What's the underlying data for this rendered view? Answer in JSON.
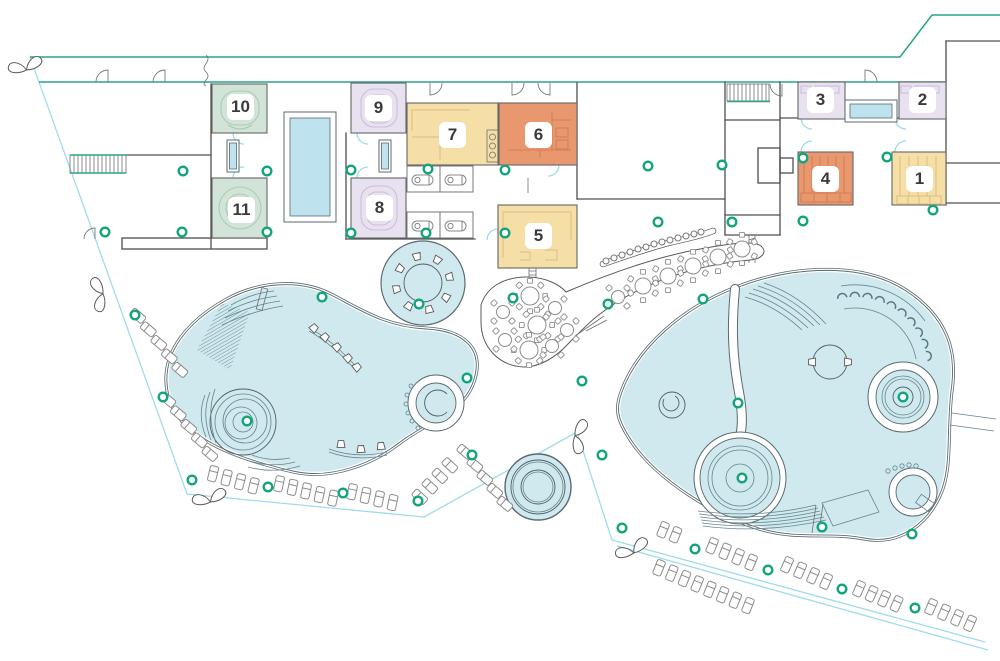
{
  "rooms": [
    {
      "number": "1",
      "zone": "yellow"
    },
    {
      "number": "2",
      "zone": "lavender"
    },
    {
      "number": "3",
      "zone": "lavender"
    },
    {
      "number": "4",
      "zone": "coral"
    },
    {
      "number": "5",
      "zone": "yellow"
    },
    {
      "number": "6",
      "zone": "coral"
    },
    {
      "number": "7",
      "zone": "yellow"
    },
    {
      "number": "8",
      "zone": "lavender"
    },
    {
      "number": "9",
      "zone": "lavender"
    },
    {
      "number": "10",
      "zone": "green"
    },
    {
      "number": "11",
      "zone": "green"
    }
  ],
  "colors": {
    "yellow_room": "#f5dfa6",
    "coral_room": "#e9976f",
    "lavender_room": "#e8e1ef",
    "green_room": "#d2e4d8",
    "pool_water": "#cfe9ef",
    "window_water": "#bfe3ee",
    "site_boundary_teal": "#2aa489",
    "site_boundary_cyan": "#9edcec",
    "column_marker": "#12a57c",
    "wall": "#4f4f4f"
  },
  "markers": {
    "columns": [
      [
        183,
        171
      ],
      [
        267,
        171
      ],
      [
        105,
        232
      ],
      [
        182,
        232
      ],
      [
        267,
        232
      ],
      [
        351,
        170
      ],
      [
        428,
        169
      ],
      [
        505,
        170
      ],
      [
        351,
        233
      ],
      [
        426,
        233
      ],
      [
        505,
        233
      ],
      [
        648,
        166
      ],
      [
        722,
        165
      ],
      [
        658,
        222
      ],
      [
        732,
        222
      ],
      [
        803,
        158
      ],
      [
        887,
        157
      ],
      [
        803,
        221
      ],
      [
        933,
        210
      ],
      [
        513,
        298
      ],
      [
        608,
        304
      ],
      [
        703,
        299
      ],
      [
        322,
        297
      ],
      [
        247,
        421
      ],
      [
        419,
        304
      ],
      [
        467,
        378
      ],
      [
        582,
        381
      ],
      [
        602,
        455
      ],
      [
        738,
        403
      ],
      [
        742,
        478
      ],
      [
        903,
        397
      ],
      [
        822,
        527
      ],
      [
        912,
        534
      ],
      [
        135,
        315
      ],
      [
        163,
        397
      ],
      [
        192,
        480
      ],
      [
        268,
        487
      ],
      [
        343,
        493
      ],
      [
        418,
        501
      ],
      [
        472,
        455
      ],
      [
        622,
        528
      ],
      [
        695,
        549
      ],
      [
        768,
        570
      ],
      [
        842,
        589
      ],
      [
        915,
        608
      ]
    ]
  },
  "furniture": {
    "lounger_rows": [
      {
        "x": 138,
        "y": 316,
        "dx": 10.5,
        "dy": 13.5,
        "n": 5,
        "rot": -50
      },
      {
        "x": 168,
        "y": 400,
        "dx": 10.5,
        "dy": 13.5,
        "n": 5,
        "rot": -50
      },
      {
        "x": 213,
        "y": 474,
        "dx": 13.5,
        "dy": 4.0,
        "n": 4,
        "rot": 14
      },
      {
        "x": 279,
        "y": 484,
        "dx": 13.5,
        "dy": 3.6,
        "n": 5,
        "rot": 12
      },
      {
        "x": 352,
        "y": 492,
        "dx": 13.5,
        "dy": 3.6,
        "n": 4,
        "rot": 12
      },
      {
        "x": 420,
        "y": 497,
        "dx": 10.0,
        "dy": -10.5,
        "n": 4,
        "rot": -47
      },
      {
        "x": 465,
        "y": 452,
        "dx": 10.0,
        "dy": 13.0,
        "n": 5,
        "rot": -50
      },
      {
        "x": 663,
        "y": 530,
        "dx": 12.5,
        "dy": 5.0,
        "n": 2,
        "rot": 22
      },
      {
        "x": 659,
        "y": 568,
        "dx": 12.7,
        "dy": 5.4,
        "n": 8,
        "rot": 22
      },
      {
        "x": 712,
        "y": 546,
        "dx": 13.0,
        "dy": 5.5,
        "n": 4,
        "rot": 22
      },
      {
        "x": 787,
        "y": 565,
        "dx": 13.0,
        "dy": 5.5,
        "n": 4,
        "rot": 24
      },
      {
        "x": 859,
        "y": 589,
        "dx": 12.5,
        "dy": 5.0,
        "n": 4,
        "rot": 24
      },
      {
        "x": 931,
        "y": 607,
        "dx": 13.0,
        "dy": 5.5,
        "n": 4,
        "rot": 24
      }
    ],
    "tables": [
      {
        "x": 530,
        "y": 296,
        "r": 9,
        "chairs": 8
      },
      {
        "x": 537,
        "y": 325,
        "r": 9,
        "chairs": 8
      },
      {
        "x": 529,
        "y": 350,
        "r": 9,
        "chairs": 8
      },
      {
        "x": 503,
        "y": 312,
        "r": 6.5,
        "chairs": 4
      },
      {
        "x": 555,
        "y": 308,
        "r": 6.5,
        "chairs": 4
      },
      {
        "x": 567,
        "y": 330,
        "r": 6.5,
        "chairs": 4
      },
      {
        "x": 505,
        "y": 340,
        "r": 6.5,
        "chairs": 4
      },
      {
        "x": 552,
        "y": 346,
        "r": 6.5,
        "chairs": 4
      },
      {
        "x": 618,
        "y": 297,
        "r": 6.5,
        "chairs": 4
      },
      {
        "x": 643,
        "y": 286,
        "r": 8,
        "chairs": 6
      },
      {
        "x": 668,
        "y": 276,
        "r": 8,
        "chairs": 6
      },
      {
        "x": 693,
        "y": 266,
        "r": 8,
        "chairs": 6
      },
      {
        "x": 718,
        "y": 257,
        "r": 8,
        "chairs": 6
      },
      {
        "x": 742,
        "y": 249,
        "r": 8,
        "chairs": 6
      }
    ],
    "bar_stools": [
      [
        606,
        261
      ],
      [
        614,
        258
      ],
      [
        622,
        255
      ],
      [
        630,
        252
      ],
      [
        638,
        249
      ],
      [
        646,
        247
      ],
      [
        654,
        244
      ],
      [
        662,
        242
      ],
      [
        670,
        240
      ],
      [
        678,
        238
      ],
      [
        686,
        236
      ],
      [
        694,
        234
      ],
      [
        701,
        232
      ]
    ],
    "water_loungers": {
      "cx": 855,
      "cy": 370,
      "r": 76,
      "a_start": 100,
      "a_end": 11,
      "count": 10
    },
    "jacuzzi_seats": {
      "cx": 423,
      "cy": 283,
      "r": 27,
      "count": 8,
      "start": 13
    },
    "pool_seats": [
      {
        "x": 314,
        "y": 328,
        "rot": -135
      },
      {
        "x": 325,
        "y": 337,
        "rot": -135
      },
      {
        "x": 337,
        "y": 347,
        "rot": -130
      },
      {
        "x": 348,
        "y": 358,
        "rot": -130
      },
      {
        "x": 357,
        "y": 367,
        "rot": -128
      },
      {
        "x": 341,
        "y": 444,
        "rot": 180
      },
      {
        "x": 361,
        "y": 449,
        "rot": 178
      },
      {
        "x": 381,
        "y": 446,
        "rot": 175
      },
      {
        "x": 812,
        "y": 362,
        "rot": 90
      },
      {
        "x": 848,
        "y": 362,
        "rot": -90
      }
    ],
    "trees": [
      {
        "x": 26,
        "y": 68,
        "rot": -15
      },
      {
        "x": 101,
        "y": 294,
        "rot": -100
      },
      {
        "x": 210,
        "y": 500,
        "rot": -15
      },
      {
        "x": 633,
        "y": 551,
        "rot": -25
      },
      {
        "x": 577,
        "y": 436,
        "rot": 100
      }
    ]
  }
}
